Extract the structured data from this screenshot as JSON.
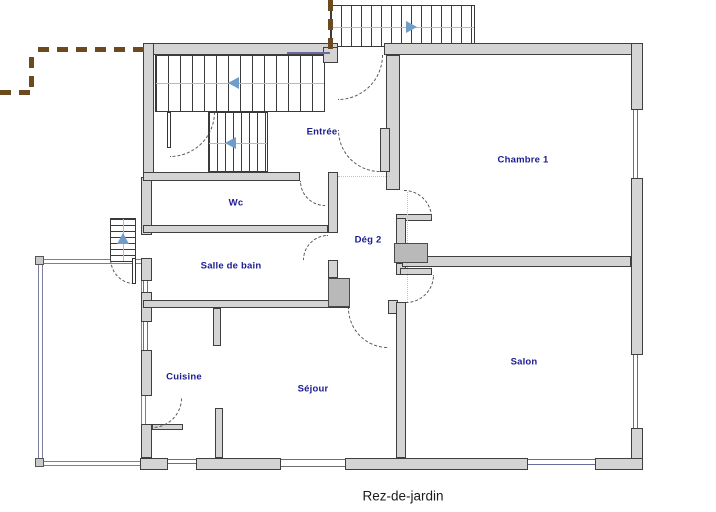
{
  "plan": {
    "caption": "Rez-de-jardin",
    "type": "floor-plan"
  },
  "rooms": {
    "entree": {
      "label": "Entrée"
    },
    "chambre1": {
      "label": "Chambre 1"
    },
    "wc": {
      "label": "Wc"
    },
    "deg2": {
      "label": "Dég 2"
    },
    "salle_de_bain": {
      "label": "Salle de bain"
    },
    "cuisine": {
      "label": "Cuisine"
    },
    "sejour": {
      "label": "Séjour"
    },
    "salon": {
      "label": "Salon"
    }
  },
  "stairs": {
    "interior_main": {
      "direction": "left"
    },
    "interior_lower": {
      "direction": "left"
    },
    "exterior_top": {
      "direction": "right"
    },
    "exterior_left": {
      "direction": "up"
    }
  },
  "colors": {
    "wall_fill": "#d4d4d4",
    "wall_outline": "#3f3f3f",
    "room_label": "#1b1b91",
    "window_line": "#6a6a9c",
    "stair_arrow": "#6f9cc9",
    "property_line": "#6b4a1f"
  }
}
